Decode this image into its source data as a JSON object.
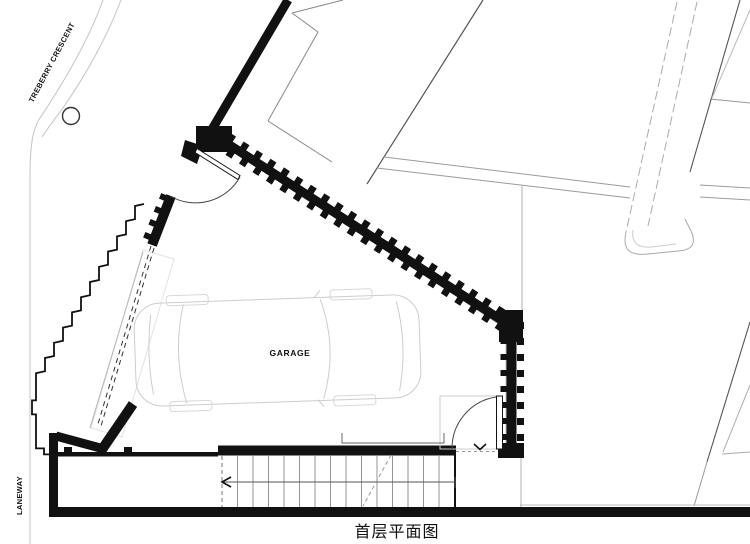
{
  "title": "首层平面图",
  "labels": {
    "street": "TREBERRY CRESCENT",
    "laneway": "LANEWAY",
    "room": "GARAGE"
  },
  "colors": {
    "wall": "#111111",
    "medium_line": "#777777",
    "thin_line": "#999999",
    "faint_line": "#cccccc",
    "background": "#ffffff"
  }
}
